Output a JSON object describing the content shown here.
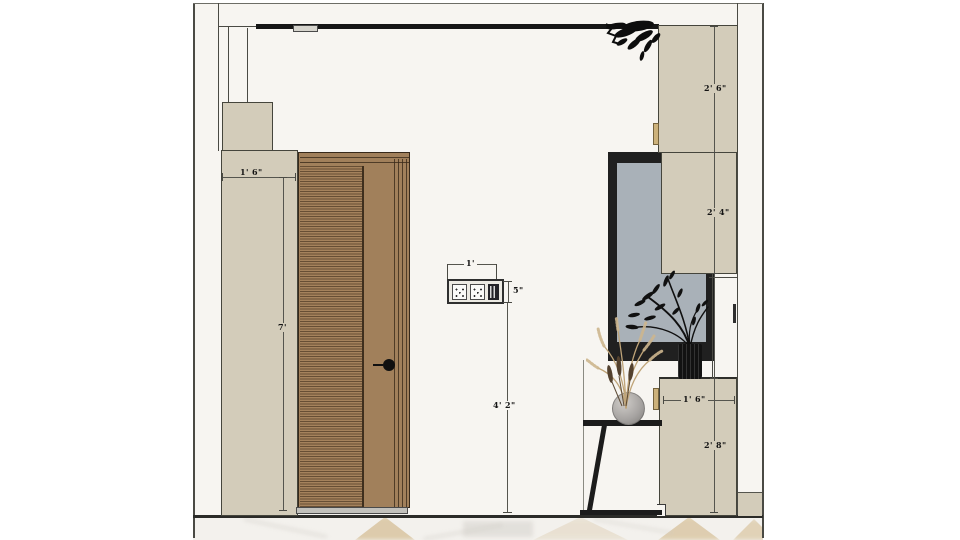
{
  "drawing": {
    "type": "interior-elevation",
    "dims": {
      "left_panel_width": "1' 6\"",
      "door_height": "7'",
      "outlet_width": "1'",
      "outlet_height": "5\"",
      "outlet_mount_height": "4' 2\"",
      "upper_cabinet_height": "2' 6\"",
      "mid_cabinet_height": "2' 4\"",
      "base_cabinet_width": "1' 6\"",
      "base_cabinet_height": "2' 8\""
    },
    "colors": {
      "wall_beige": "#d3ccba",
      "door_wood": "#a1805b",
      "mirror_glass": "#a9b1b8",
      "accents_black": "#1c1c1c",
      "room_background": "#f7f5f1",
      "marble_vein_tan": "#d9c5a0"
    }
  }
}
